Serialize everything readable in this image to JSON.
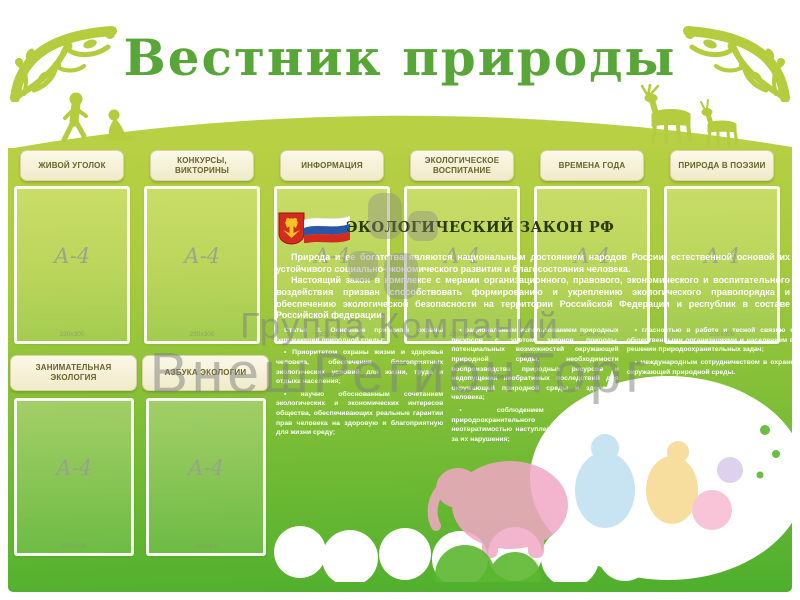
{
  "poster": {
    "title": "Вестник природы",
    "sections_top": [
      {
        "label": "ЖИВОЙ УГОЛОК"
      },
      {
        "label": "КОНКУРСЫ, ВИКТОРИНЫ"
      },
      {
        "label": "ИНФОРМАЦИЯ"
      },
      {
        "label": "ЭКОЛОГИЧЕСКОЕ ВОСПИТАНИЕ"
      },
      {
        "label": "ВРЕМЕНА ГОДА"
      },
      {
        "label": "ПРИРОДА В ПОЭЗИИ"
      }
    ],
    "sections_bottom": [
      {
        "label": "ЗАНИМАТЕЛЬНАЯ ЭКОЛОГИЯ"
      },
      {
        "label": "АЗБУКА ЭКОЛОГИИ"
      }
    ],
    "pocket": {
      "label": "А-4",
      "size": "230x300"
    },
    "law": {
      "title": "ЭКОЛОГИЧЕСКИЙ ЗАКОН РФ",
      "intro1": "Природа и ее богатства являются национальным достоянием народов России, естественной основой их устойчивого социально-экономического развития и благосостояния человека.",
      "intro2": "Настоящий закон в комплексе с мерами организационного, правового, экономического и воспитательного воздействия призван способствовать формированию и укреплению экологического правопорядка и обеспечению экологической безопасности на территории Российской Федерации и республик в составе Российской федерации.",
      "columns": [
        [
          "Статья 3. Основные принципы охраны окружающей природной среды:",
          "• Приоритетом охраны жизни и здоровья человека, обеспечения благоприятных экологических условий для жизни, труда и отдыха населения;",
          "• научно обоснованным сочетанием экологических и экономических интересов общества, обеспечивающих реальные гарантии прав человека на здоровую и благоприятную для жизни среду;"
        ],
        [
          "• рациональным использованием природных ресурсов с учетом законов природы, потенциальных возможностей окружающей природной среды, необходимости воспроизводства природных ресурсов и недопущения необратимых последствий для окружающей природной среды и здоровья человека;",
          "• соблюдением требований природоохранительного законодательства, неотвратимостью наступления ответственности за их нарушения;"
        ],
        [
          "• гласностью в работе и тесной связью с общественными организациями и населением в решении природоохранительных задач;",
          "• международным сотрудничеством в охране окружающей природной среды."
        ]
      ]
    },
    "icons": {
      "coat_of_arms": "red-shield-double-eagle",
      "flag": "russian-tricolor",
      "corner_flourish": "green-damask-ornament",
      "children_silhouette": "running-child-and-sitting-child",
      "deer_silhouette": "two-deer",
      "animals_illustration": "pastel-animals-on-white-cloud"
    },
    "colors": {
      "title_green": "#58a637",
      "board_top": "#b8d044",
      "board_bottom": "#4daf2d",
      "plaque_cream": "#f5f0d4",
      "plaque_text": "#6a6128",
      "law_title": "#2c3703",
      "text_white": "#ffffff"
    }
  },
  "watermark": {
    "line1": "Группа Компаний",
    "line2": "ВнешРегионТорг",
    "logo": "rounded-squares-logo"
  }
}
